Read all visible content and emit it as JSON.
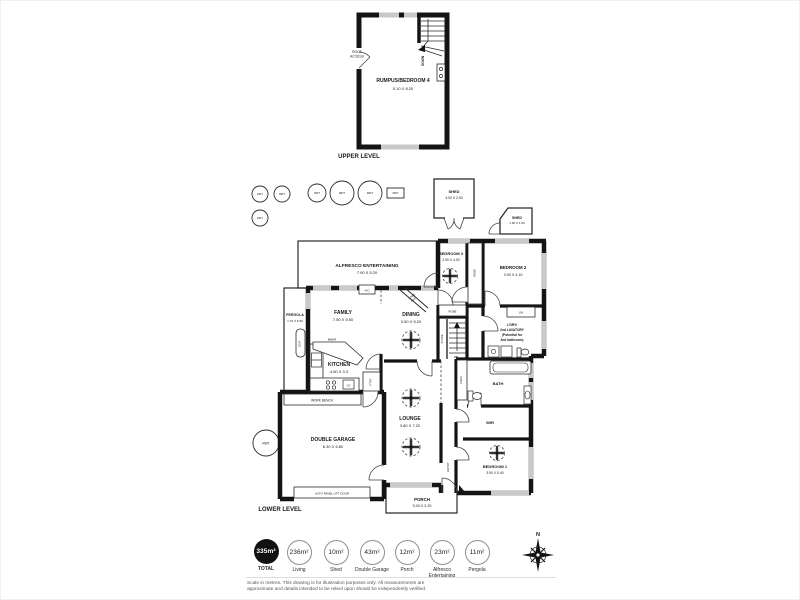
{
  "levels": {
    "upper_label": "UPPER LEVEL",
    "lower_label": "LOWER LEVEL"
  },
  "rooms": {
    "rumpus": {
      "name": "RUMPUS/BEDROOM 4",
      "dims": "5.10 X 8.20"
    },
    "alfresco": {
      "name": "ALFRESCO ENTERTAINING",
      "dims": "7.90 X 5.20"
    },
    "pergola": {
      "name": "PERGOLA",
      "dims": "1.70 X 6.60"
    },
    "family": {
      "name": "FAMILY",
      "dims": "7.50 X 5.50"
    },
    "dining": {
      "name": "DINING",
      "dims": "3.50 X 5.20"
    },
    "kitchen": {
      "name": "KITCHEN",
      "dims": "4.60 X 3.3"
    },
    "lounge": {
      "name": "LOUNGE",
      "dims": "3.80 X 7.20"
    },
    "garage": {
      "name": "DOUBLE GARAGE",
      "dims": "6.30 X 6.80"
    },
    "porch": {
      "name": "PORCH",
      "dims": "5.40 X 2.20"
    },
    "bedroom1": {
      "name": "BEDROOM 1",
      "dims": "3.90 X 5.40"
    },
    "bedroom2": {
      "name": "BEDROOM 2",
      "dims": "3.90 X 4.10"
    },
    "bedroom3": {
      "name": "BEDROOM 3",
      "dims": "2.90 X 4.00"
    },
    "shed_large": {
      "name": "SHED",
      "dims": "3.00 X 2.50"
    },
    "shed_small": {
      "name": "SHED",
      "dims": "1.60 X 1.60"
    },
    "bath": {
      "name": "BATH"
    },
    "wir": {
      "name": "WIR"
    },
    "laundry": {
      "line1": "L'DRY/",
      "line2": "2nd LAVATORY",
      "line3": "(Potential for",
      "line4": "2nd bathroom)"
    }
  },
  "fixtures": {
    "roof_access_line1": "ROOF",
    "roof_access_line2": "ACCESS",
    "down": "DOWN",
    "up": "UP",
    "seat": "SEAT",
    "rwt": "RWT",
    "ac": "A/C",
    "comb_line1": "COMB",
    "comb_line2": "HEAT",
    "bbar": "B/BAR",
    "pantry": "P'TRY",
    "oven": "OV",
    "work_bench": "WORK BENCH",
    "garage_door": "AUTO PANEL LIFT DOOR",
    "robe": "ROBE",
    "lin": "LIN",
    "store": "STORE",
    "linen": "LINEN",
    "entry": "ENTRY"
  },
  "legend": {
    "items": [
      {
        "value": "335m²",
        "label": "TOTAL",
        "filled": true
      },
      {
        "value": "236m²",
        "label": "Living"
      },
      {
        "value": "10m²",
        "label": "Shed"
      },
      {
        "value": "43m²",
        "label": "Double Garage"
      },
      {
        "value": "12m²",
        "label": "Porch"
      },
      {
        "value": "23m²",
        "label": "Alfresco Entertaining"
      },
      {
        "value": "11m²",
        "label": "Pergola"
      }
    ]
  },
  "compass": {
    "north": "N"
  },
  "disclaimer": {
    "line1": "Scale in metres. This drawing is for illustration purposes only. All measurements are",
    "line2": "approximate and details intended to be relied upon should be independently verified."
  },
  "colors": {
    "wall": "#141414",
    "window": "#c9c9c9",
    "legend_fill": "#111111"
  }
}
